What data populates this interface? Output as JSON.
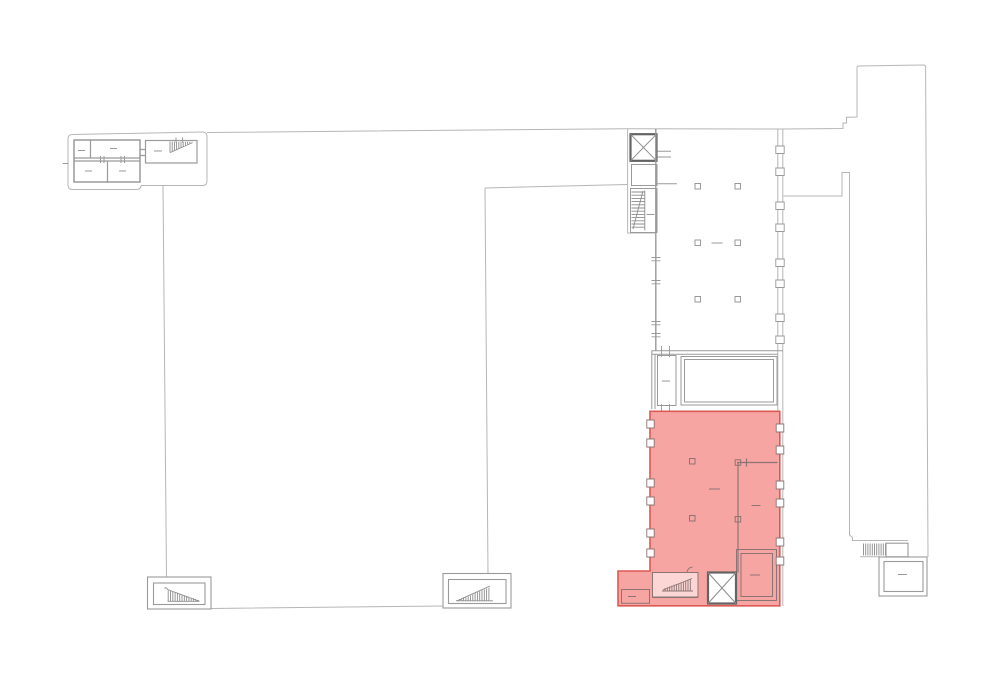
{
  "meta": {
    "title": "architectural-floor-plan",
    "width": 1000,
    "height": 679
  },
  "colors": {
    "background": "#ffffff",
    "line_light": "#b6b6b6",
    "line_mid": "#9a9a9a",
    "line_dark": "#636363",
    "hatch": "#8c8c8c",
    "shaft_fill": "#ffffff",
    "highlight_fill": "#f6a5a3",
    "highlight_stroke": "#dd5a54",
    "highlight_detail": "#8d7474"
  },
  "icons": {
    "elevator": "crossed-square",
    "stairs": "hatched-run"
  },
  "highlight": {
    "role": "selected-unit"
  }
}
